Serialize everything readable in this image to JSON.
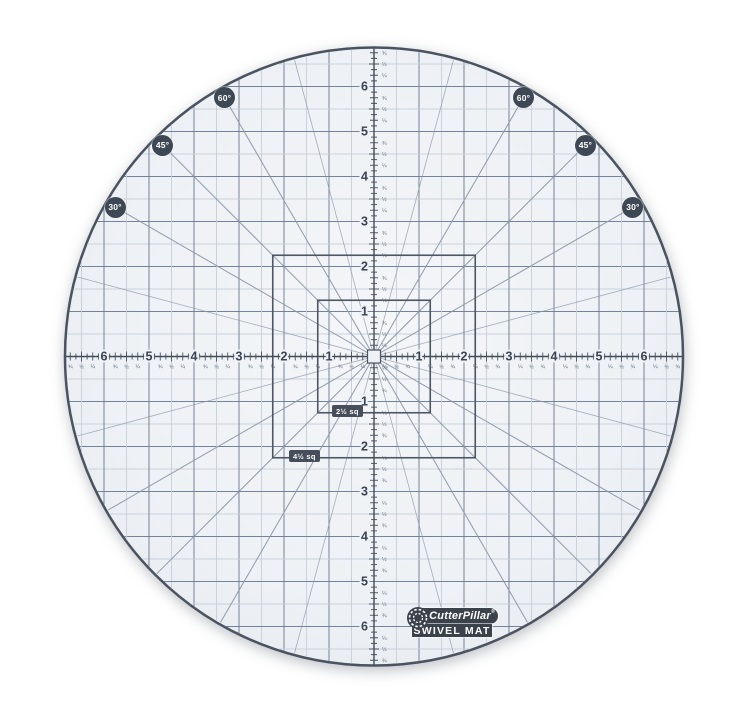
{
  "mat": {
    "surface_color": "#eef1f5",
    "surface_center_color": "#f4f6f8",
    "surface_edge_color": "#e7ebf1",
    "rim_color": "#4a535f",
    "grid_major_color": "#6e7c92",
    "grid_minor_color": "#c7ced9",
    "ray_color": "#8a96a8",
    "ink_color": "#3a4350",
    "tick_color": "#46505d",
    "fraction_color": "#5f6977",
    "center_x": 374,
    "center_y": 356.5,
    "radius": 309,
    "inch_px": 45,
    "ruler": {
      "numbers": [
        1,
        2,
        3,
        4,
        5,
        6
      ],
      "fractions": [
        "¼",
        "½",
        "¾"
      ],
      "max_extent_in": 6.75
    },
    "ray_angles_deg": [
      15,
      30,
      45,
      60,
      75
    ],
    "angle_badges": [
      {
        "label": "60°",
        "angle_deg": 60
      },
      {
        "label": "45°",
        "angle_deg": 45
      },
      {
        "label": "30°",
        "angle_deg": 30
      }
    ],
    "badge_radius": 299,
    "squares": [
      {
        "label": "2½ sq",
        "size_in": 2.5
      },
      {
        "label": "4½ sq",
        "size_in": 4.5
      }
    ],
    "logo": {
      "brand": "CutterPillar",
      "registered": "®",
      "product": "SWIVEL MAT"
    }
  }
}
